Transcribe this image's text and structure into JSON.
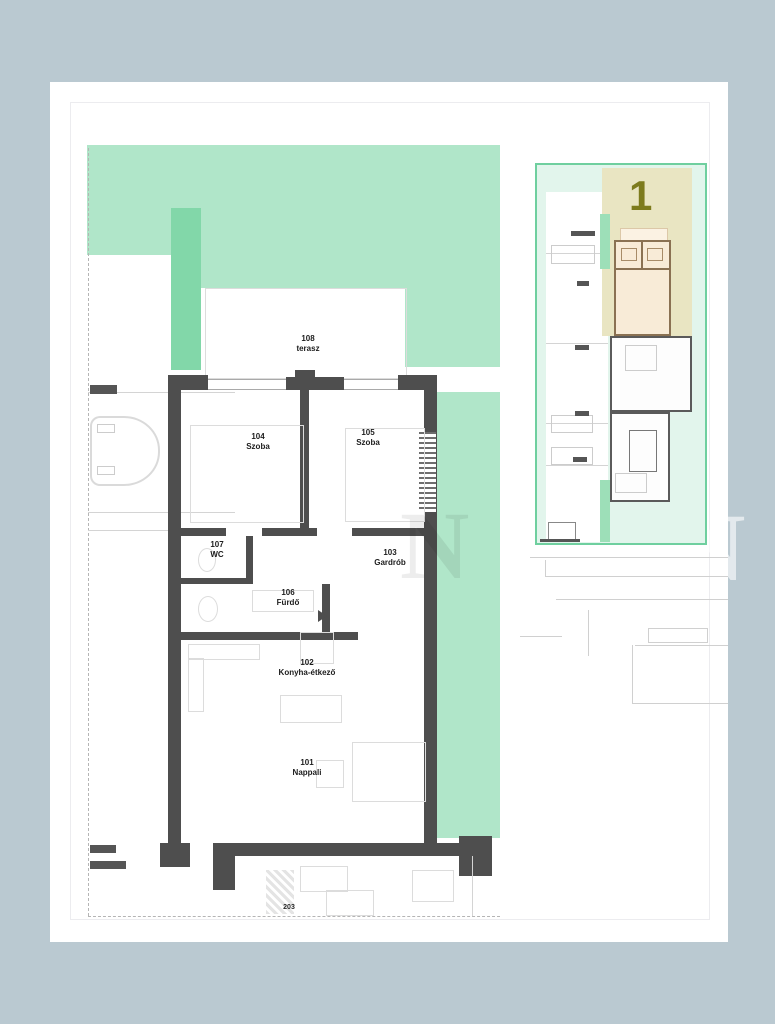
{
  "floor_plan": {
    "rooms": [
      {
        "number": "108",
        "name": "terasz"
      },
      {
        "number": "104",
        "name": "Szoba"
      },
      {
        "number": "105",
        "name": "Szoba"
      },
      {
        "number": "107",
        "name": "WC"
      },
      {
        "number": "103",
        "name": "Gardrób"
      },
      {
        "number": "106",
        "name": "Fürdő"
      },
      {
        "number": "102",
        "name": "Konyha-étkező"
      },
      {
        "number": "101",
        "name": "Nappali"
      }
    ],
    "adjacent_room_number": "203"
  },
  "site_plan": {
    "highlighted_unit": "1"
  },
  "watermark": {
    "letter": "N"
  },
  "colors": {
    "background": "#bac9d1",
    "garden_green": "#b0e6c9",
    "garden_green_dark": "#82d7a9",
    "site_border_green": "#6fcf9f",
    "highlight_tan": "#e9e5c2",
    "highlight_unit_fill": "#f8ebd7",
    "unit_number_olive": "#7d7b1d",
    "wall_gray": "#4e4e4e"
  }
}
